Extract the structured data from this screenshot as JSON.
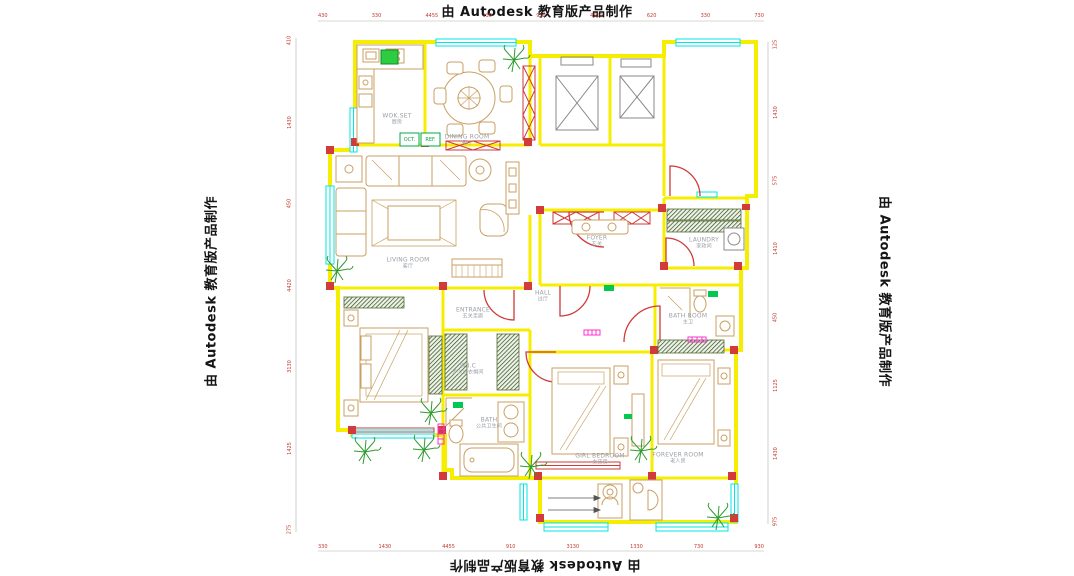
{
  "watermark": {
    "text": "由 Autodesk 教育版产品制作"
  },
  "rooms": {
    "kitchen": {
      "en": "WOK.SET",
      "cn": "厨房"
    },
    "dining": {
      "en": "DINING ROOM",
      "cn": "餐厅"
    },
    "living": {
      "en": "LIVING ROOM",
      "cn": "客厅"
    },
    "foyer": {
      "en": "FOYER",
      "cn": "玄关"
    },
    "laundry": {
      "en": "LAUNDRY",
      "cn": "家政间"
    },
    "entrance": {
      "en": "ENTRANCE",
      "cn": "玄关走廊"
    },
    "hall": {
      "en": "HALL",
      "cn": "过厅"
    },
    "wic": {
      "en": "W.I.C",
      "cn": "步入式衣帽间"
    },
    "master_bath": {
      "en": "BATH ROOM",
      "cn": "主卫"
    },
    "bath": {
      "en": "BATH",
      "cn": "公共卫生间"
    },
    "girl_bedroom": {
      "en": "GIRL BEDROOM",
      "cn": "女孩房"
    },
    "forever_room": {
      "en": "FOREVER ROOM",
      "cn": "老人房"
    }
  },
  "tags": {
    "kitchen_left": "OCT.",
    "kitchen_right": "REF."
  },
  "dims": {
    "top": [
      "430",
      "330",
      "4455",
      "130",
      "910",
      "4510",
      "620",
      "330",
      "730"
    ],
    "bottom": [
      "330",
      "1430",
      "4455",
      "910",
      "3130",
      "1330",
      "730",
      "930"
    ],
    "left": [
      "410",
      "1430",
      "450",
      "4420",
      "3130",
      "1425",
      "275"
    ],
    "right": [
      "125",
      "1430",
      "575",
      "1410",
      "450",
      "1125",
      "1430",
      "975"
    ]
  },
  "colors": {
    "wall": "#f5ee00",
    "window": "#00e5e5",
    "door": "#cf3a3a",
    "dim_text": "#c0392b",
    "label": "#9aa0a6",
    "plant": "#2e9b2e",
    "accent_green": "#00c853",
    "accent_magenta": "#ff2ed2"
  }
}
